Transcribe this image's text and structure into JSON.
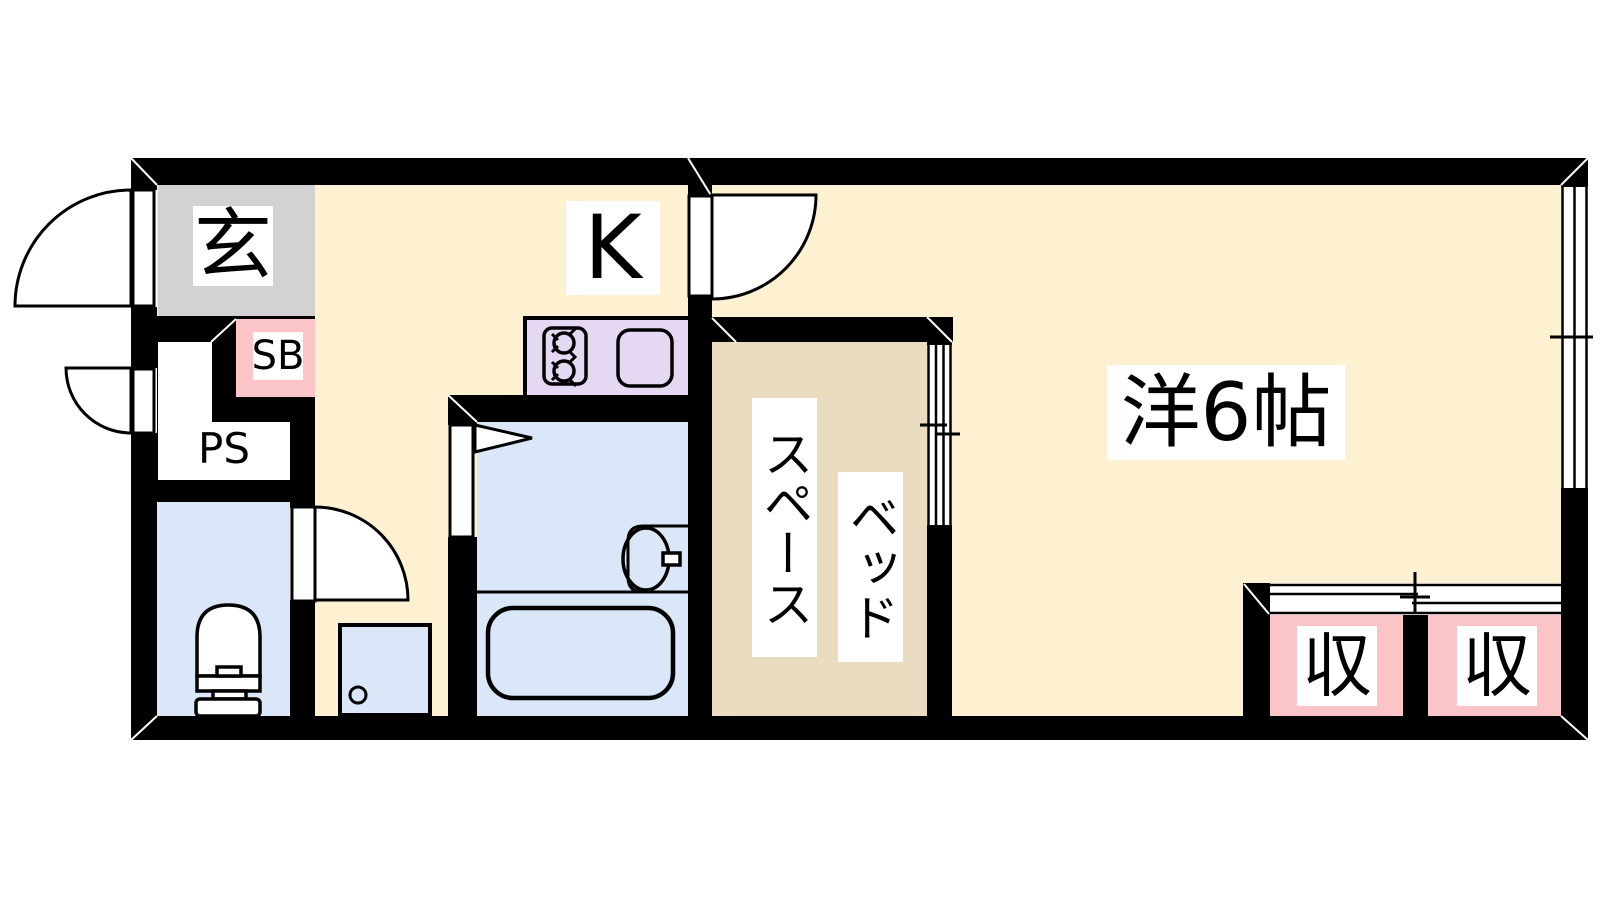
{
  "floorplan": {
    "labels": {
      "genkan": "玄",
      "shoe_box": "SB",
      "pipe_space": "PS",
      "kitchen": "K",
      "western_room": "洋6帖",
      "bed": "ベッド",
      "bed_space": "スペース",
      "closet_left": "収",
      "closet_right": "収"
    },
    "colors": {
      "floor_cream": "#fdf1d1",
      "bed_space_tan": "#e9dcc1",
      "bath_blue": "#d9e7f8",
      "closet_pink": "#fbc5c8",
      "counter_lavender": "#e5d8f2",
      "genkan_gray": "#d2d2d2",
      "wall_black": "#000000"
    }
  }
}
